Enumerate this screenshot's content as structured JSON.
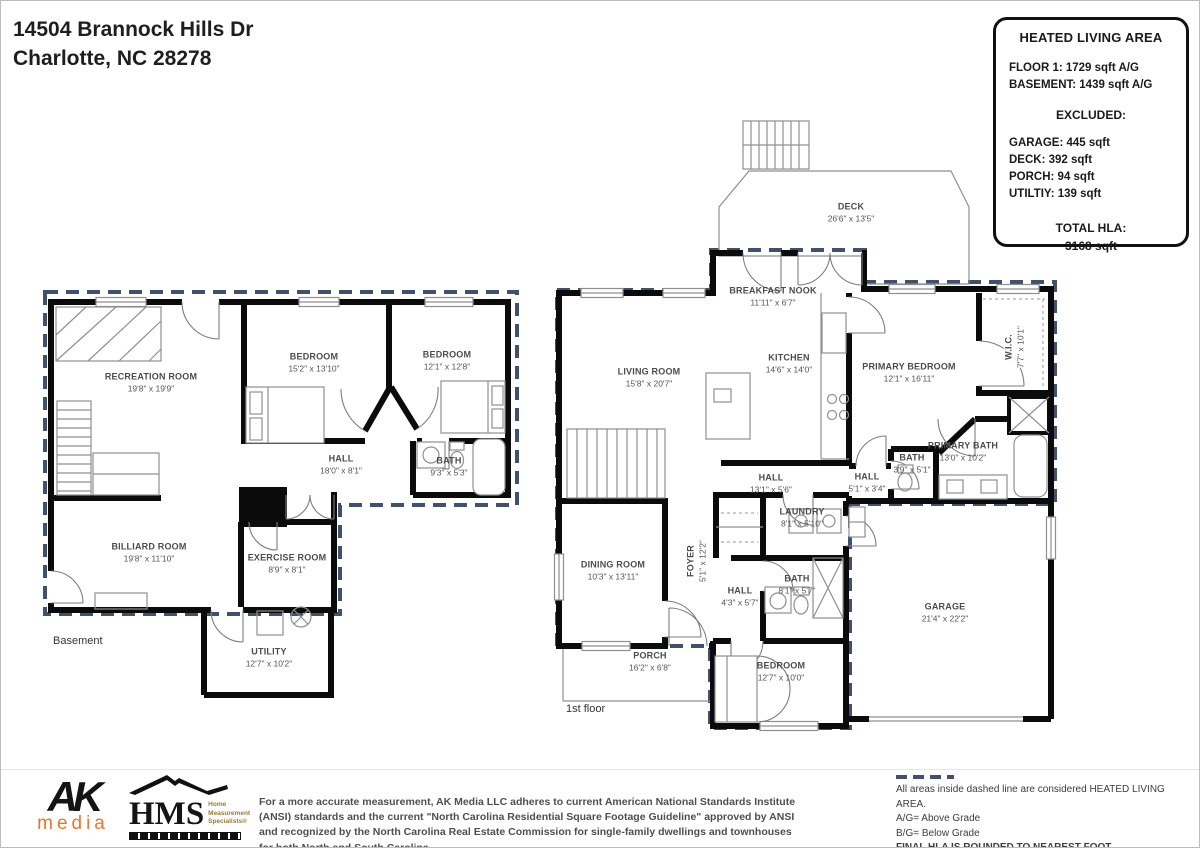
{
  "address": {
    "line1": "14504 Brannock Hills Dr",
    "line2": "Charlotte, NC  28278"
  },
  "hla_box": {
    "title": "HEATED LIVING AREA",
    "floor_lines": [
      "FLOOR 1: 1729 sqft  A/G",
      "BASEMENT: 1439 sqft  A/G"
    ],
    "excluded_label": "EXCLUDED:",
    "excluded_lines": [
      "GARAGE: 445 sqft",
      "DECK: 392 sqft",
      "PORCH: 94 sqft",
      "UTILTIY: 139 sqft"
    ],
    "total_label": "TOTAL HLA:",
    "total_value": "3168 sqft"
  },
  "basement": {
    "floor_label": "Basement",
    "rooms": [
      {
        "name": "RECREATION ROOM",
        "dims": "19'8\" x 19'9\""
      },
      {
        "name": "BEDROOM",
        "dims": "15'2\" x 13'10\""
      },
      {
        "name": "BEDROOM",
        "dims": "12'1\" x 12'8\""
      },
      {
        "name": "HALL",
        "dims": "18'0\" x 8'1\""
      },
      {
        "name": "BATH",
        "dims": "9'3\" x 5'3\""
      },
      {
        "name": "BILLIARD ROOM",
        "dims": "19'8\" x 11'10\""
      },
      {
        "name": "EXERCISE ROOM",
        "dims": "8'9\" x 8'1\""
      },
      {
        "name": "UTILITY",
        "dims": "12'7\" x 10'2\""
      }
    ]
  },
  "first_floor": {
    "floor_label": "1st floor",
    "rooms": [
      {
        "name": "DECK",
        "dims": "26'6\" x 13'5\""
      },
      {
        "name": "BREAKFAST NOOK",
        "dims": "11'11\" x 6'7\""
      },
      {
        "name": "LIVING ROOM",
        "dims": "15'8\" x 20'7\""
      },
      {
        "name": "KITCHEN",
        "dims": "14'6\" x 14'0\""
      },
      {
        "name": "PRIMARY BEDROOM",
        "dims": "12'1\" x 16'11\""
      },
      {
        "name": "W.I.C.",
        "dims": "7'7\" x 10'1\""
      },
      {
        "name": "PRIMARY BATH",
        "dims": "13'0\" x 10'2\""
      },
      {
        "name": "BATH",
        "dims": "3'9\" x 5'1\""
      },
      {
        "name": "HALL",
        "dims": "5'1\" x 3'4\""
      },
      {
        "name": "HALL",
        "dims": "13'1\" x 5'6\""
      },
      {
        "name": "LAUNDRY",
        "dims": "8'1\" x 5'10\""
      },
      {
        "name": "FOYER",
        "dims": "5'1\" x 12'2\""
      },
      {
        "name": "HALL",
        "dims": "4'3\" x 5'7\""
      },
      {
        "name": "BATH",
        "dims": "8'1\" x 5'7\""
      },
      {
        "name": "DINING ROOM",
        "dims": "10'3\" x 13'11\""
      },
      {
        "name": "PORCH",
        "dims": "16'2\" x 6'8\""
      },
      {
        "name": "GARAGE",
        "dims": "21'4\" x 22'2\""
      },
      {
        "name": "BEDROOM",
        "dims": "12'7\" x 10'0\""
      }
    ]
  },
  "footer": {
    "ak_logo": {
      "line1": "AK",
      "line2": "media"
    },
    "hms_logo": {
      "acronym": "HMS",
      "tag1": "Home",
      "tag2": "Measurement",
      "tag3": "Specialists®"
    },
    "disclaimer": "For a more accurate measurement, AK Media LLC adheres to current American National Standards Institute (ANSI) standards and the current \"North Carolina Residential Square Footage Guideline\" approved by ANSI and recognized by the North Carolina Real Estate Commission for single-family dwellings and townhouses for both North and South Carolina.",
    "legend": {
      "line1": "All areas inside dashed line are considered HEATED LIVING AREA.",
      "line2": "A/G= Above Grade",
      "line3": "B/G= Below Grade",
      "line4": "FINAL HLA IS ROUNDED TO NEAREST FOOT"
    }
  },
  "colors": {
    "dashed_boundary": "#40516f",
    "wall": "#0b0b0b",
    "ak_orange": "#e8762c",
    "hms_gold": "#9c7a2f"
  }
}
